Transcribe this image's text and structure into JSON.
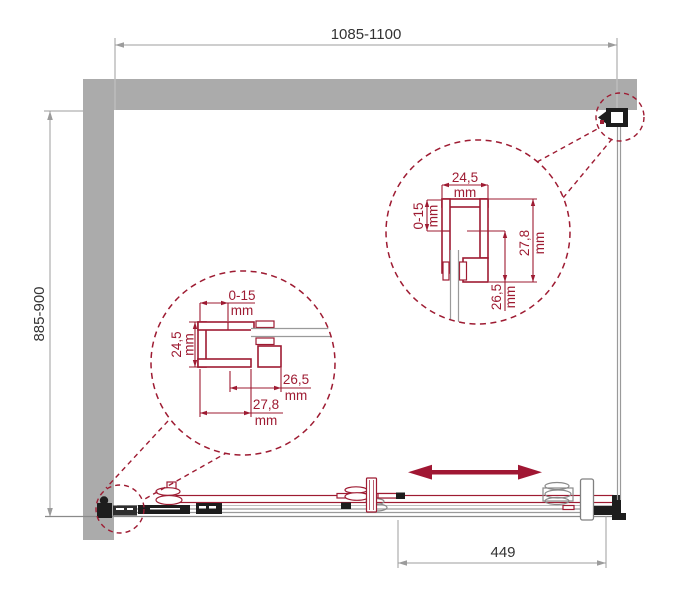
{
  "meta": {
    "type": "technical-drawing",
    "subject": "sliding-shower-door-plan-view"
  },
  "colors": {
    "accent": "#9e1b32",
    "direction_arrow": "#a01733",
    "wall": "#ababab",
    "dimension_line": "#9c9c9c",
    "dimension_text": "#333333",
    "hardware_dark": "#1d1d1d",
    "glass_line": "#9a9a9a"
  },
  "dims": {
    "width": "1085-1100",
    "depth": "885-900",
    "travel": "449"
  },
  "detail_right": {
    "top": {
      "value": "24,5",
      "unit": "mm"
    },
    "side": {
      "value": "0-15",
      "unit": "mm"
    },
    "inner": {
      "value": "26,5",
      "unit": "mm"
    },
    "overall": {
      "value": "27,8",
      "unit": "mm"
    }
  },
  "detail_left": {
    "top": {
      "value": "0-15",
      "unit": "mm"
    },
    "side": {
      "value": "24,5",
      "unit": "mm"
    },
    "inner": {
      "value": "26,5",
      "unit": "mm"
    },
    "overall": {
      "value": "27,8",
      "unit": "mm"
    }
  }
}
